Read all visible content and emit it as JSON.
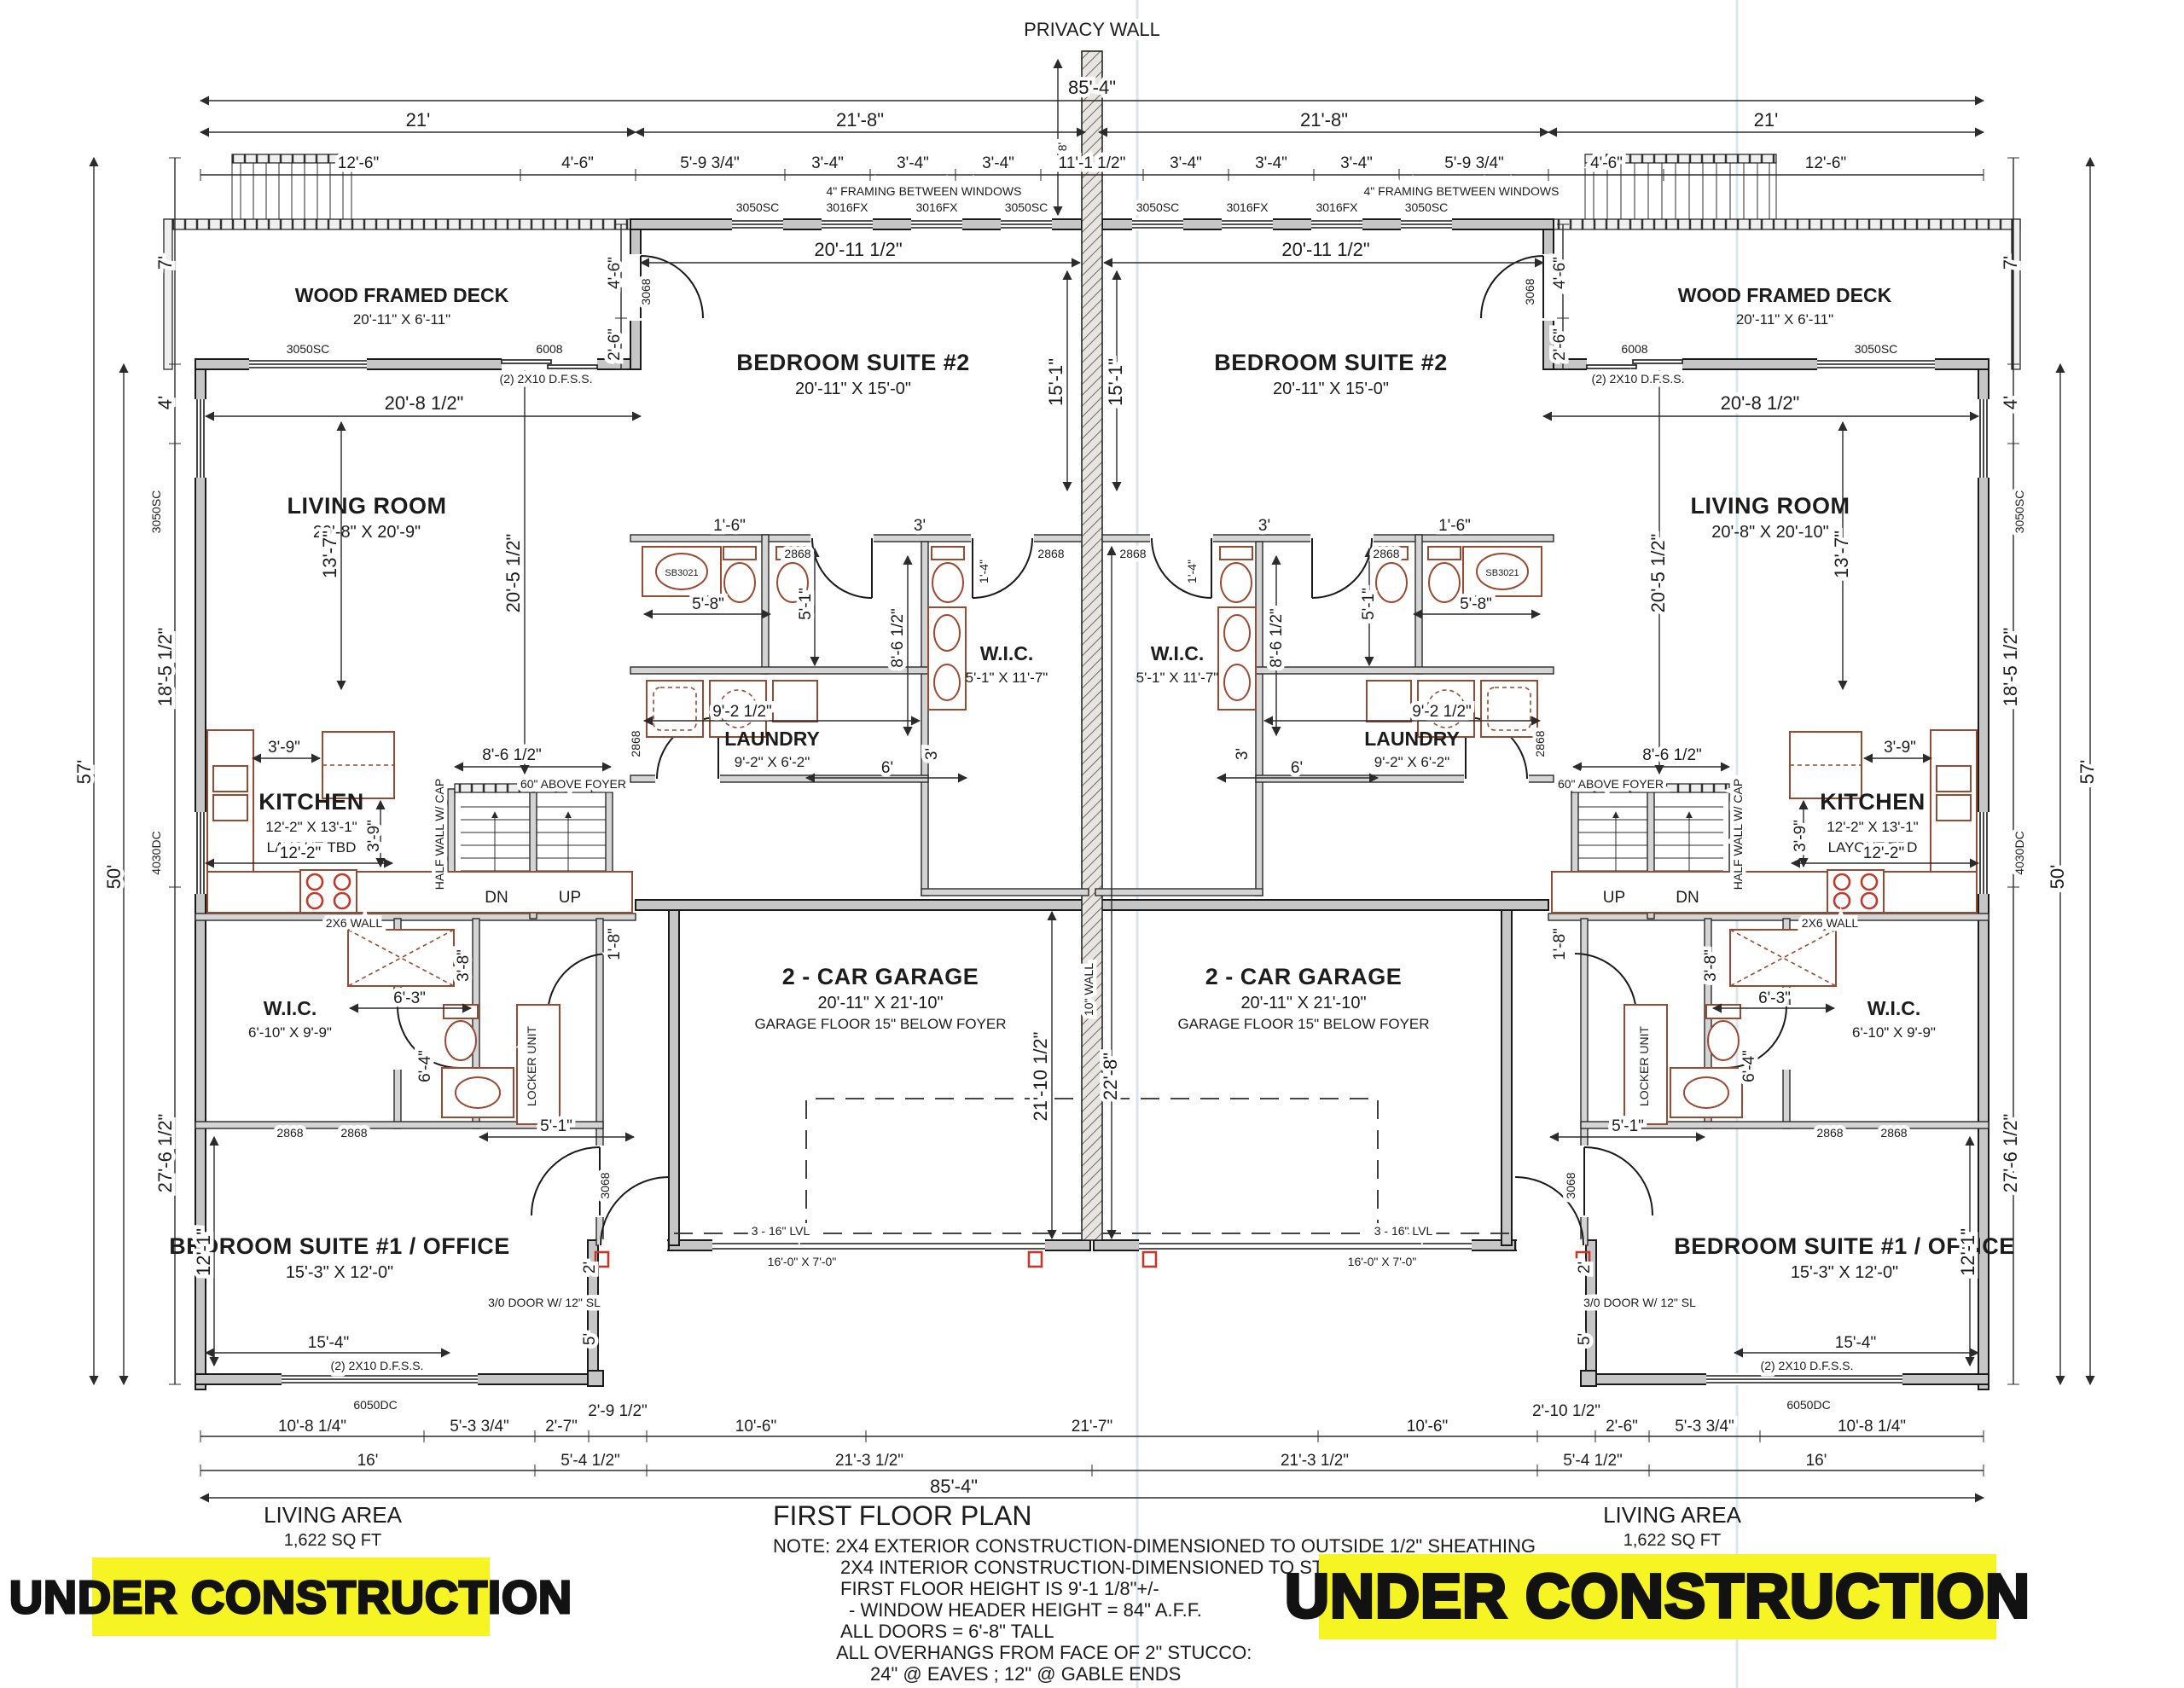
{
  "plan": {
    "title": "FIRST FLOOR PLAN",
    "living_area_label": "LIVING AREA",
    "living_area_value": "1,622 SQ FT",
    "banner": "UNDER CONSTRUCTION",
    "banner_color": "#f7f424",
    "notes": [
      "NOTE: 2X4 EXTERIOR CONSTRUCTION-DIMENSIONED TO OUTSIDE 1/2\" SHEATHING",
      "2X4 INTERIOR CONSTRUCTION-DIMENSIONED TO STUD FACE",
      "FIRST FLOOR HEIGHT IS 9'-1 1/8\"+/-",
      "- WINDOW HEADER HEIGHT = 84\" A.F.F.",
      "ALL DOORS = 6'-8\" TALL",
      "ALL OVERHANGS FROM FACE OF 2\" STUCCO:",
      "24\" @ EAVES ; 12\" @ GABLE ENDS"
    ]
  },
  "rooms": {
    "deck": {
      "name": "WOOD FRAMED DECK",
      "size": "20'-11\" X 6'-11\""
    },
    "bedroom2": {
      "name": "BEDROOM SUITE #2",
      "size": "20'-11\" X 15'-0\""
    },
    "living_l": {
      "name": "LIVING ROOM",
      "size": "20'-8\" X 20'-9\""
    },
    "living_r": {
      "name": "LIVING ROOM",
      "size": "20'-8\" X 20'-10\""
    },
    "kitchen": {
      "name": "KITCHEN",
      "size": "12'-2\" X 13'-1\"",
      "note": "LAYOUT TBD"
    },
    "laundry": {
      "name": "LAUNDRY",
      "size": "9'-2\" X 6'-2\""
    },
    "wic_c": {
      "name": "W.I.C.",
      "size": "5'-1\" X 11'-7\""
    },
    "wic_f": {
      "name": "W.I.C.",
      "size": "6'-10\" X 9'-9\""
    },
    "garage": {
      "name": "2 - CAR GARAGE",
      "size": "20'-11\" X 21'-10\"",
      "note": "GARAGE FLOOR 15\" BELOW FOYER"
    },
    "bedroom1": {
      "name": "BEDROOM SUITE #1 / OFFICE",
      "size": "15'-3\" X 12'-0\""
    }
  },
  "d": {
    "f85": "85'-4\"",
    "f21": "21'",
    "f218": "21'-8\"",
    "f126": "12'-6\"",
    "f46": "4'-6\"",
    "f5934": "5'-9 3/4\"",
    "f34": "3'-4\"",
    "f1112": "11'-1 1/2\"",
    "f8": "8'",
    "f7": "7'",
    "f57": "57'",
    "f50": "50'",
    "f4": "4'",
    "f18512": "18'-5 1/2\"",
    "f27612": "27'-6 1/2\"",
    "f26": "2'-6\"",
    "f20112": "20'-11 1/2\"",
    "f151": "15'-1\"",
    "f20812": "20'-8 1/2\"",
    "f137": "13'-7\"",
    "f16": "1'-6\"",
    "f58": "5'-8\"",
    "f51": "5'-1\"",
    "f3": "3'",
    "f14": "1'-4\"",
    "f8612": "8'-6 1/2\"",
    "f20512": "20'-5 1/2\"",
    "f9212": "9'-2 1/2\"",
    "f6": "6'",
    "f122": "12'-2\"",
    "f39": "3'-9\"",
    "f63": "6'-3\"",
    "f38": "3'-8\"",
    "f64": "6'-4\"",
    "f18": "1'-8\"",
    "f211012": "21'-10 1/2\"",
    "f228": "22'-8\"",
    "f121": "12'-1\"",
    "f154": "15'-4\"",
    "f2": "2'",
    "f5x": "5'",
    "f10814": "10'-8 1/4\"",
    "f5334": "5'-3 3/4\"",
    "f27": "2'-7\"",
    "f2912": "2'-9 1/2\"",
    "f106": "10'-6\"",
    "f217": "21'-7\"",
    "f5412": "5'-4 1/2\"",
    "f21312": "21'-3 1/2\"",
    "f21012": "2'-10 1/2\"",
    "f16f": "16'"
  },
  "codes": {
    "privacy": "PRIVACY WALL",
    "sc": "3050SC",
    "fx": "3016FX",
    "dc4030": "4030DC",
    "dc6050": "6050DC",
    "sl6008": "6008",
    "d3068": "3068",
    "d2868": "2868",
    "joist": "(2) 2X10 D.F.S.S.",
    "lvl": "3 - 16\" LVL",
    "gdoor": "16'-0\" X 7'-0\"",
    "fdoor": "3/0 DOOR W/ 12\" SL",
    "halfwall": "HALF WALL W/ CAP",
    "abovefoyer": "60\" ABOVE FOYER",
    "wall10": "10\" WALL",
    "wall2x6": "2X6 WALL",
    "framing": "4\" FRAMING BETWEEN WINDOWS",
    "locker": "LOCKER UNIT",
    "dn": "DN",
    "up": "UP",
    "sb": "SB3021"
  }
}
